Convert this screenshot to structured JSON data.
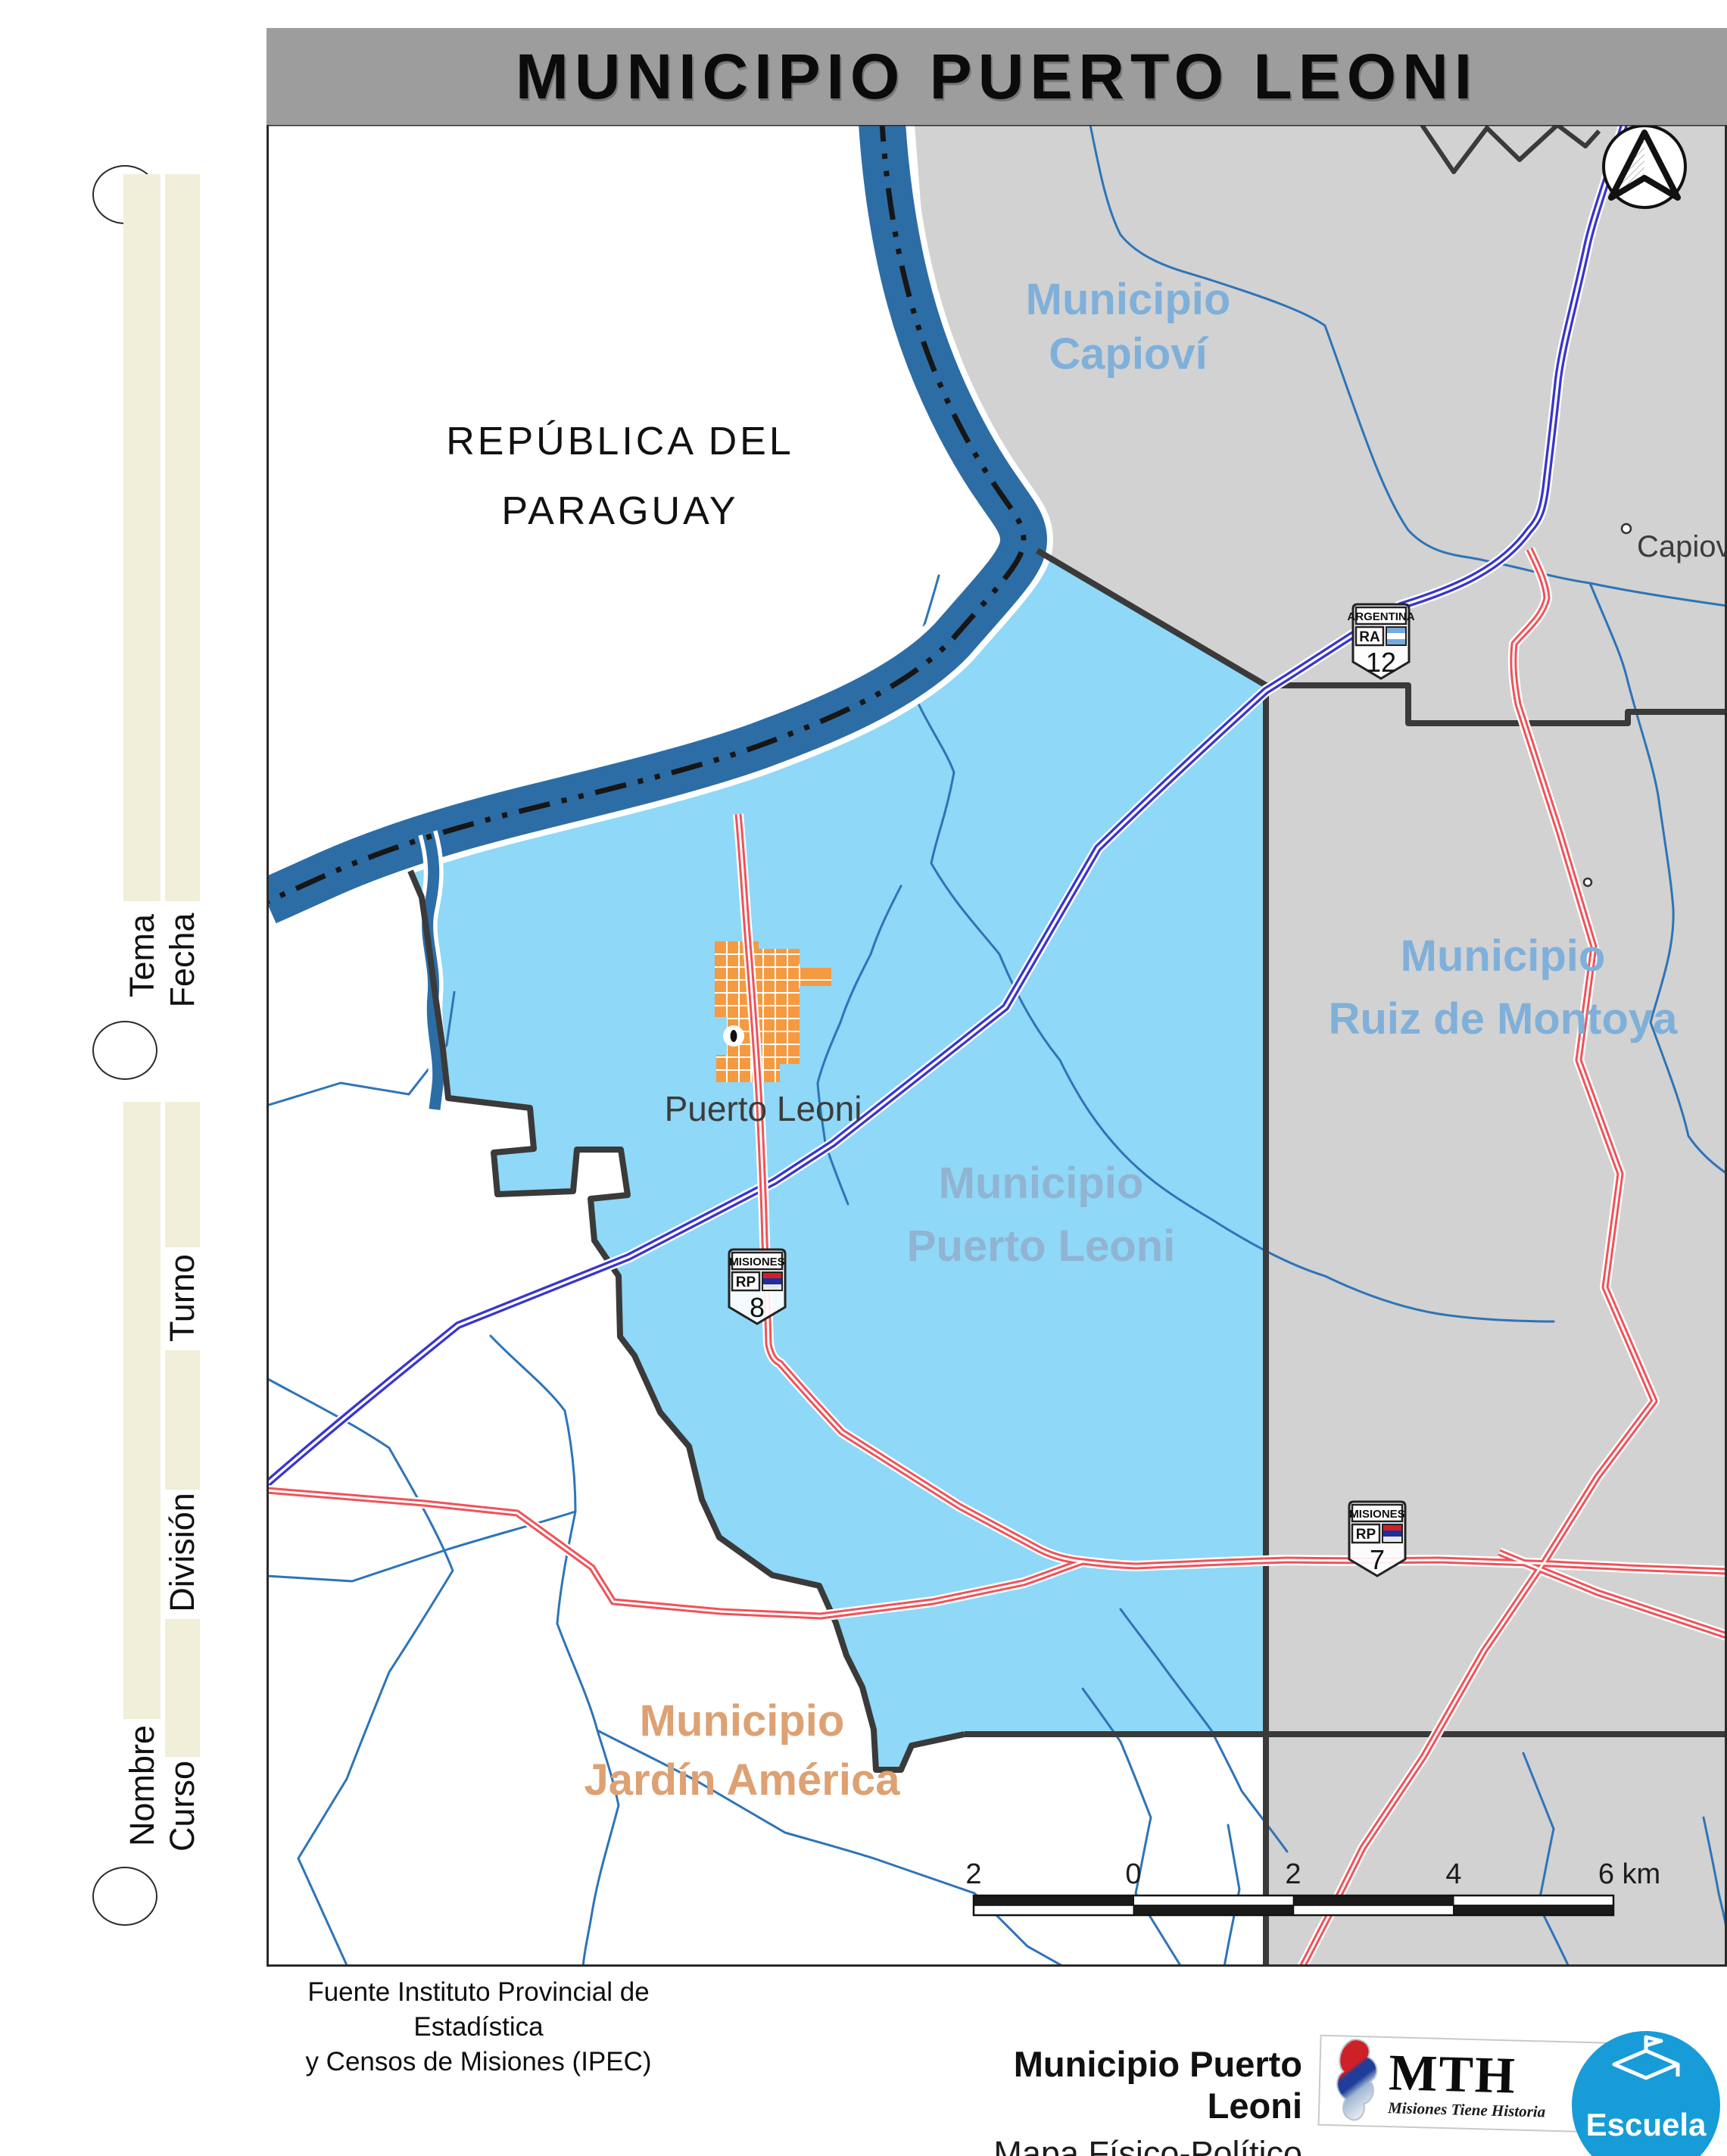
{
  "title": "MUNICIPIO PUERTO LEONI",
  "margin": {
    "fields": [
      "Tema",
      "Fecha",
      "Turno",
      "División",
      "Nombre",
      "Curso"
    ]
  },
  "map": {
    "labels": {
      "paraguay_line1": "REPÚBLICA DEL",
      "paraguay_line2": "PARAGUAY",
      "capiovi_line1": "Municipio",
      "capiovi_line2": "Capioví",
      "ruiz_line1": "Municipio",
      "ruiz_line2": "Ruiz de Montoya",
      "pleoni_line1": "Municipio",
      "pleoni_line2": "Puerto Leoni",
      "jardin_line1": "Municipio",
      "jardin_line2": "Jardín América"
    },
    "towns": {
      "puerto_leoni": "Puerto Leoni",
      "capiovi": "Capioví"
    },
    "shields": {
      "ra12": {
        "top": "ARGENTINA",
        "cls": "RA",
        "num": "12"
      },
      "rp8": {
        "top": "MISIONES",
        "cls": "RP",
        "num": "8"
      },
      "rp7": {
        "top": "MISIONES",
        "cls": "RP",
        "num": "7"
      }
    },
    "scale": {
      "labels": [
        "2",
        "0",
        "2",
        "4",
        "6 km"
      ]
    }
  },
  "footer": {
    "source_line1": "Fuente Instituto Provincial de Estadística",
    "source_line2": "y Censos de Misiones (IPEC)",
    "credit_title": "Municipio Puerto Leoni",
    "credit_subtitle": "Mapa Físico-Político",
    "logo": {
      "mth": "MTH",
      "tagline": "Misiones Tiene Historia",
      "escuela": "Escuela"
    }
  },
  "colors": {
    "title_bar": "#9d9d9d",
    "water": "#2d6da6",
    "stream": "#2e74b8",
    "municipality_fill": "#8fd8f7",
    "neighbor_fill": "#d2d2d2",
    "urban": "#f59a40",
    "road_national": "#3a35cc",
    "road_provincial": "#ef5359",
    "label_blue": "#7fb0da",
    "label_orange": "#dda173",
    "boundary": "#3a3a3a",
    "margin_bar": "#f1eed9",
    "escuela_blue": "#189cd8",
    "mth_red": "#cf2027",
    "mth_blue": "#1f3d99"
  }
}
